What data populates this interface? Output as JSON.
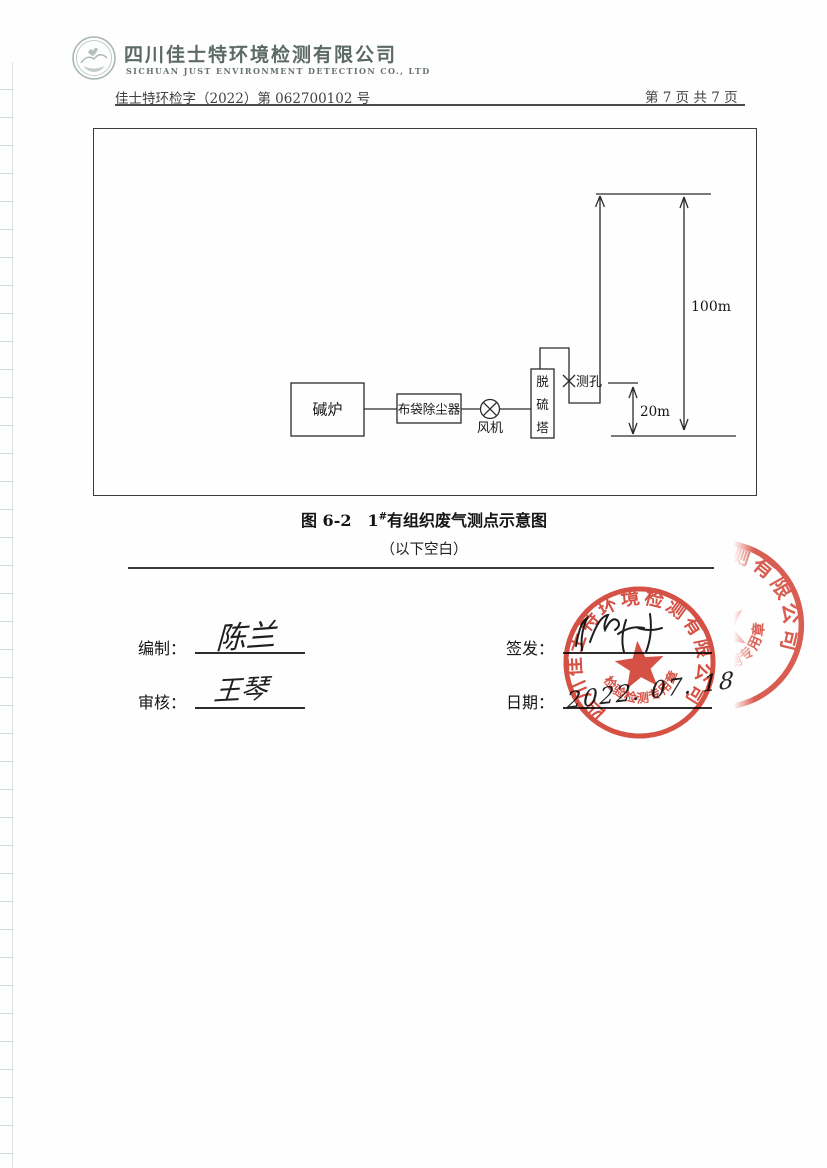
{
  "header": {
    "company_cn": "四川佳士特环境检测有限公司",
    "company_en": "SICHUAN JUST ENVIRONMENT DETECTION CO., LTD",
    "doc_number": "佳士特环检字（2022）第 062700102 号",
    "page_info": "第 7 页  共 7 页"
  },
  "diagram": {
    "furnace": "碱炉",
    "dust_collector": "布袋除尘器",
    "fan": "风机",
    "tower_chars": [
      "脱",
      "硫",
      "塔"
    ],
    "sample_port": "测孔",
    "stack_height": "100m",
    "port_height": "20m"
  },
  "caption": {
    "prefix": "图 6-2　1",
    "sup": "#",
    "title": "有组织废气测点示意图",
    "blank_note": "（以下空白）"
  },
  "signoff": {
    "bianzhi_label": "编制：",
    "bianzhi_name": "陈兰",
    "shenhe_label": "审核：",
    "shenhe_name": "王琴",
    "qianfa_label": "签发：",
    "riqi_label": "日期：",
    "riqi_value": "2022. 07. 18"
  },
  "stamp": {
    "ring_text": "四川佳士特环境检测有限公司",
    "bottom_text": "检验检测专用章",
    "color": "#d0392b"
  }
}
